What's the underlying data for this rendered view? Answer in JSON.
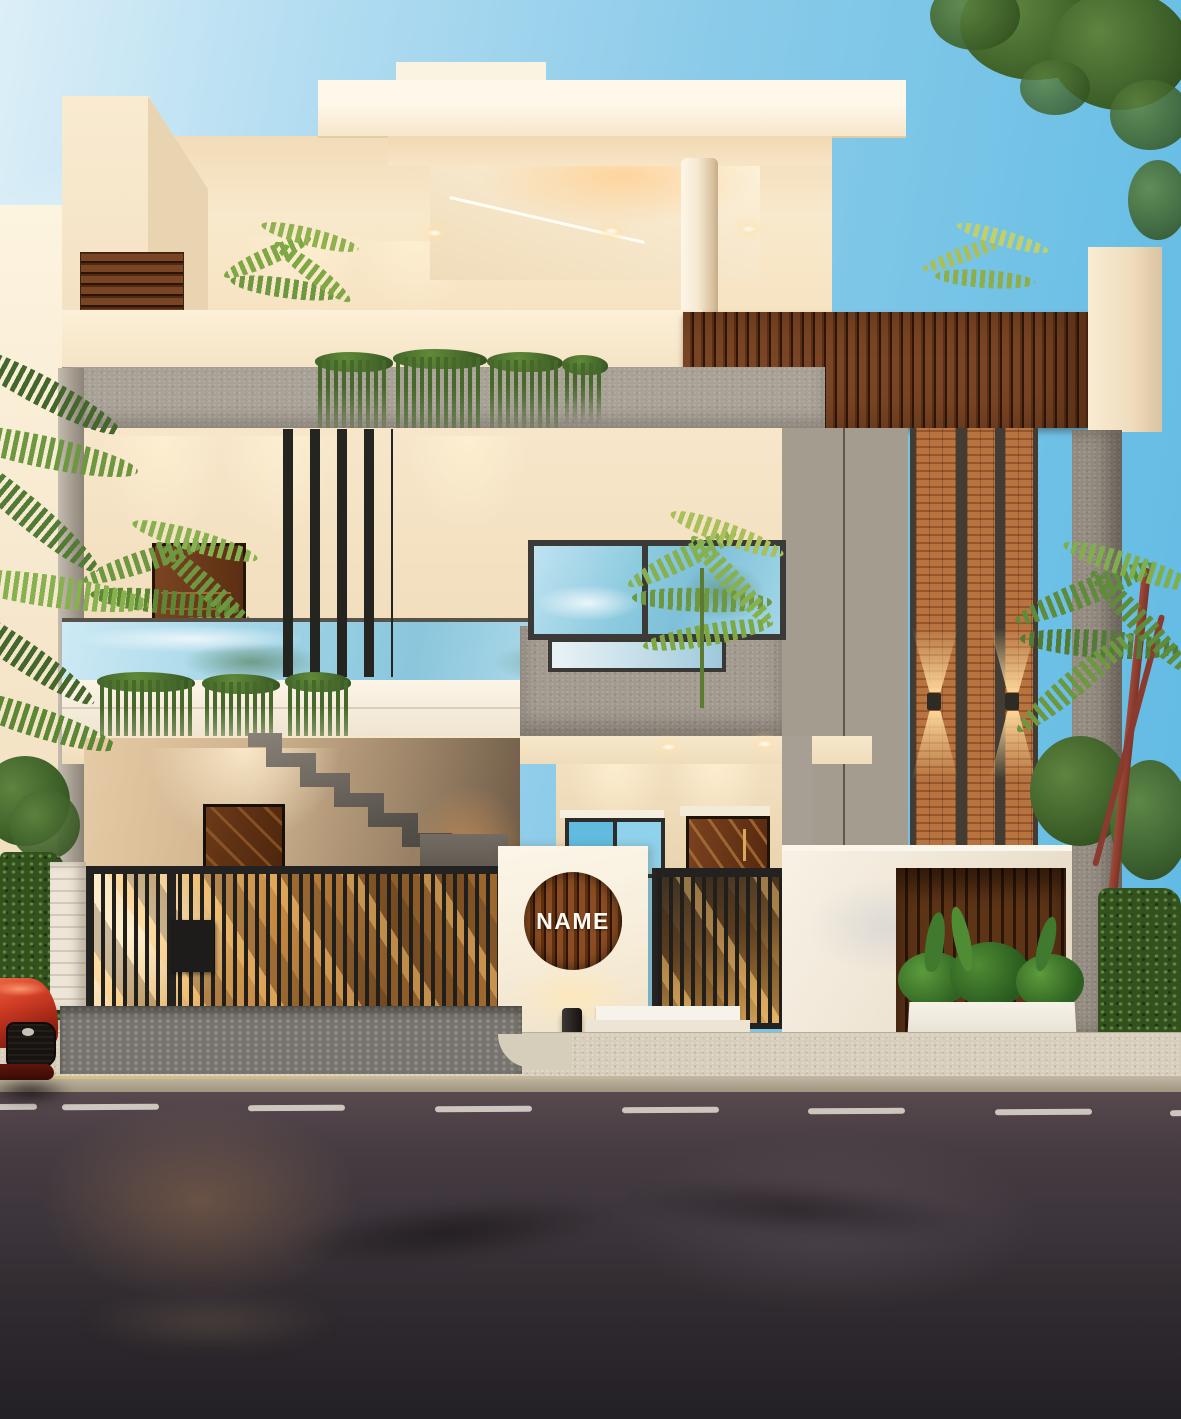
{
  "scene": {
    "type": "3d-architectural-exterior-render",
    "description": "Modern two-storey house facade at dusk with wood slat accents, brick feature column, glass balcony, metal gates, name plaque, sidewalk and asphalt road",
    "name_plaque": {
      "label": "NAME"
    },
    "palette": {
      "sky_blue": "#7cc5e8",
      "wall_cream": "#f5e5c8",
      "wood_brown": "#6e3d1c",
      "brick_orange": "#b06f3c",
      "concrete_gray": "#9d958a",
      "gate_black": "#232220",
      "glass_blue": "#8ac6dc",
      "foliage_green": "#4a6b2f",
      "warm_light": "#ffd9a0",
      "asphalt_gray": "#38323a",
      "sidewalk_beige": "#d6ccba",
      "car_red": "#c23a28"
    }
  }
}
